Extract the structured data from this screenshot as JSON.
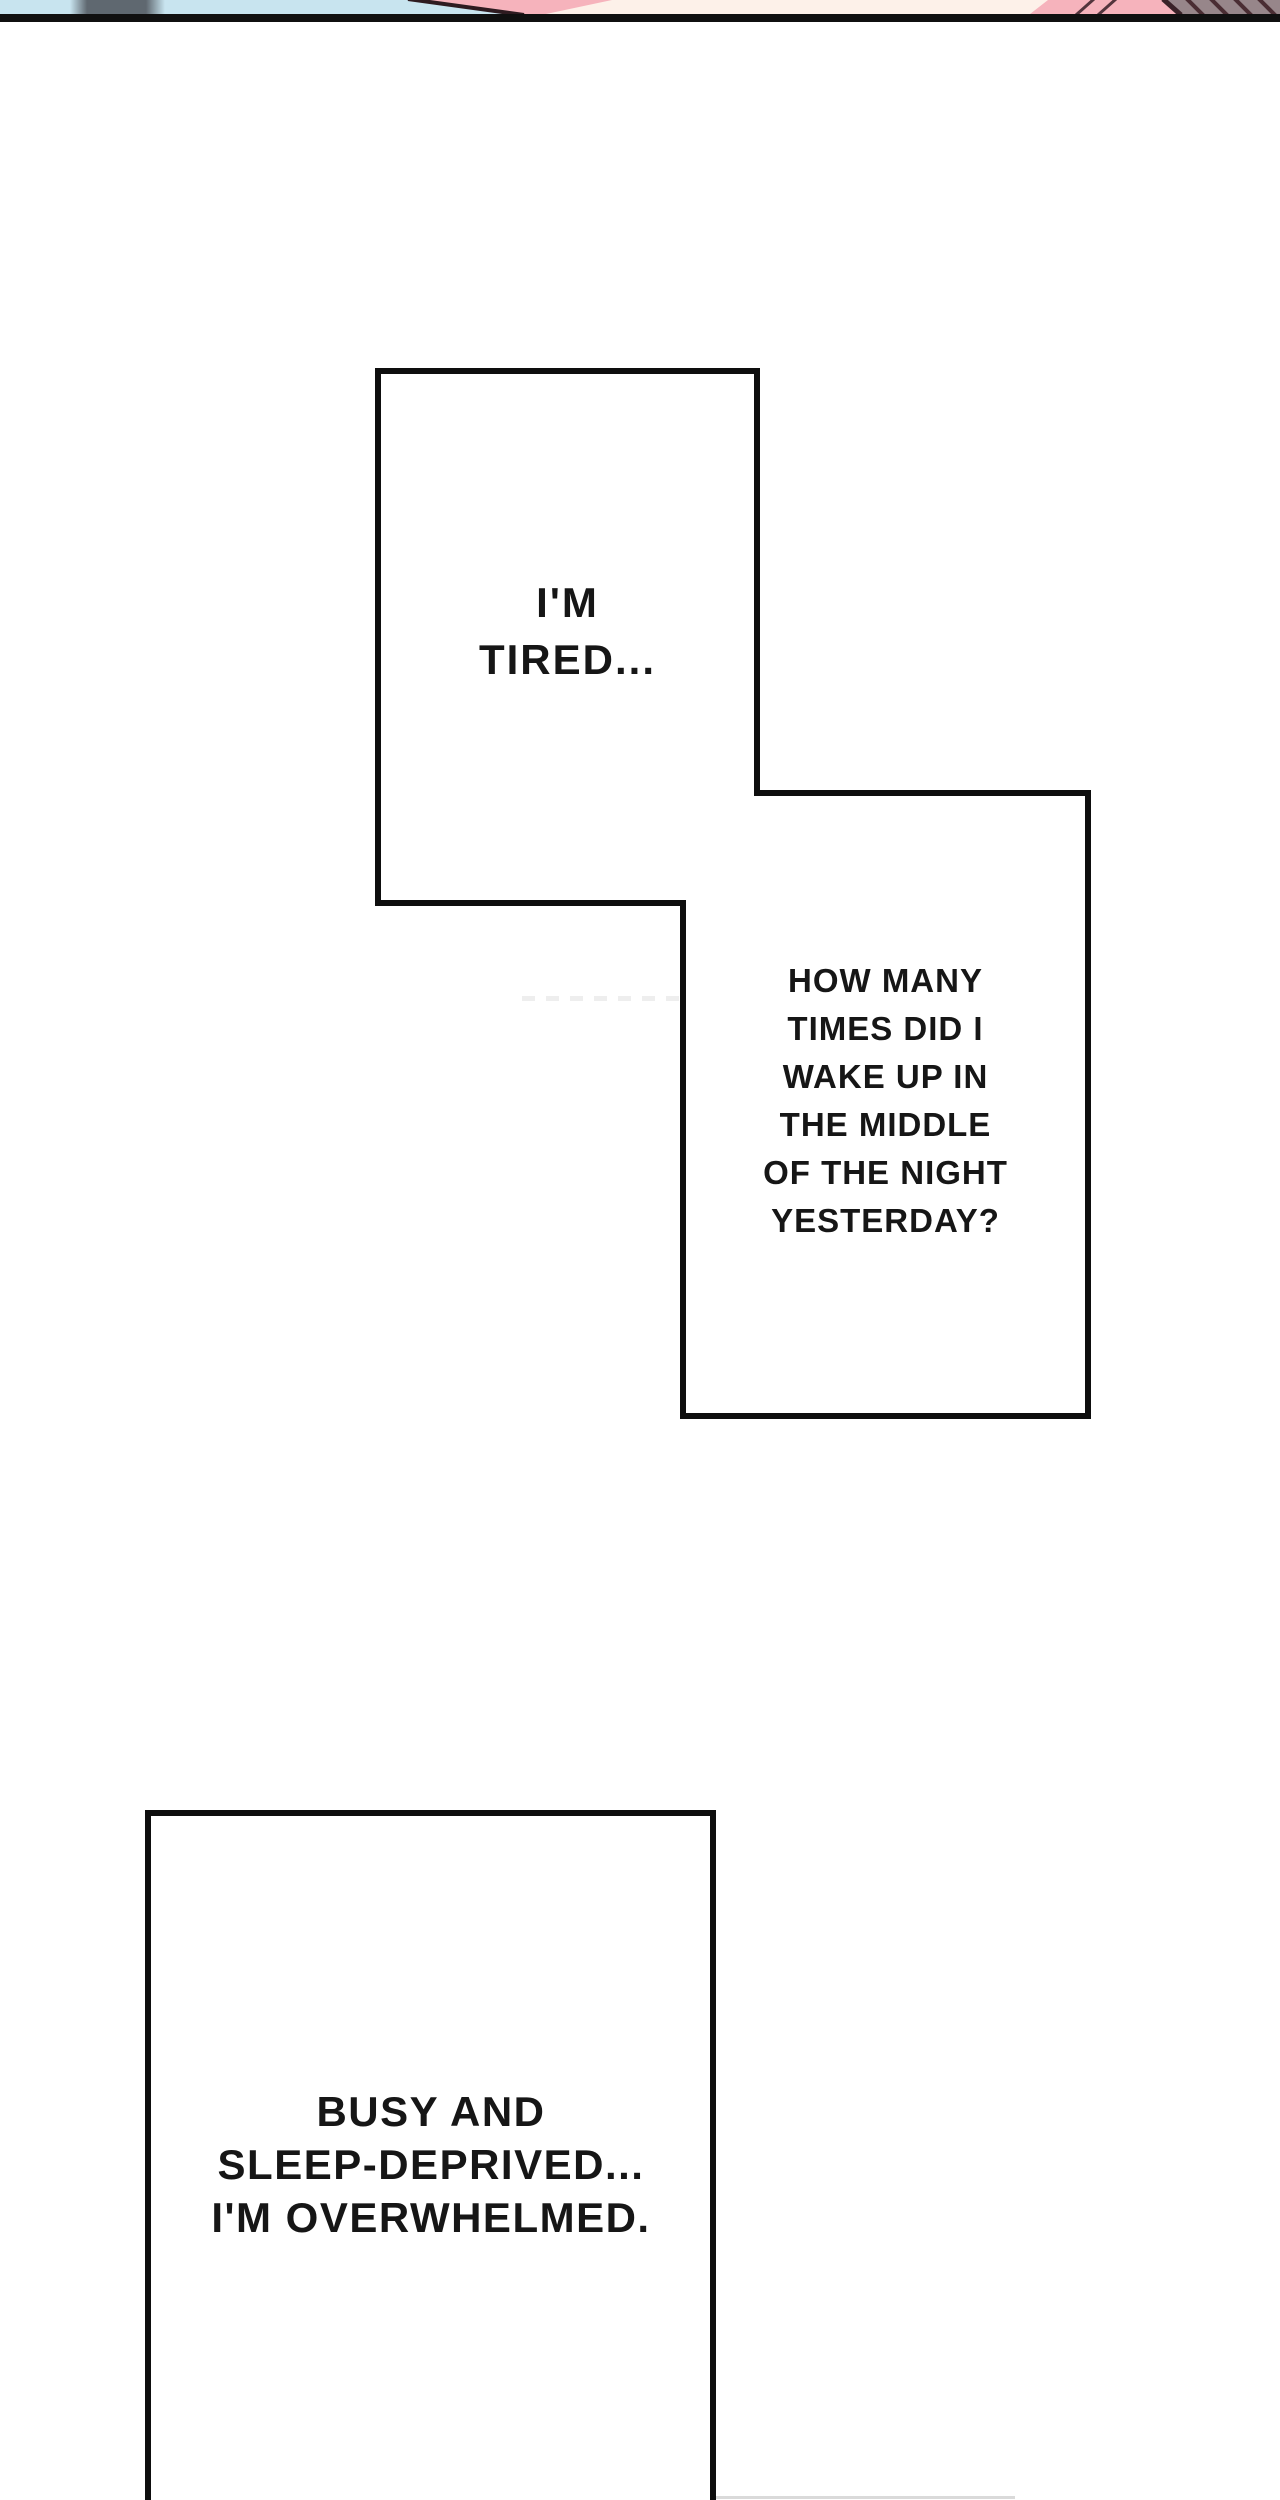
{
  "page": {
    "background": "#ffffff",
    "divider_color": "#101010",
    "outline_color": "#0e0e0e"
  },
  "previous_panel_strip": {
    "colors": {
      "sky_blue": "#c8e4ef",
      "gray_object": "#5f6870",
      "skin_pink": "#f6b3bc",
      "cream": "#fdf1e9",
      "dark_outline": "#2e1b20",
      "hatch_background": "#97868a",
      "hatch_stroke": "#4a2d33"
    }
  },
  "bubbles": [
    {
      "name": "bubble-1",
      "lines": [
        "I'M",
        "TIRED..."
      ]
    },
    {
      "name": "bubble-2",
      "lines": [
        "HOW MANY",
        "TIMES DID I",
        "WAKE UP IN",
        "THE MIDDLE",
        "OF THE NIGHT",
        "YESTERDAY?"
      ]
    },
    {
      "name": "bubble-3",
      "lines": [
        "BUSY AND",
        "SLEEP-DEPRIVED...",
        "I'M OVERWHELMED."
      ]
    }
  ]
}
